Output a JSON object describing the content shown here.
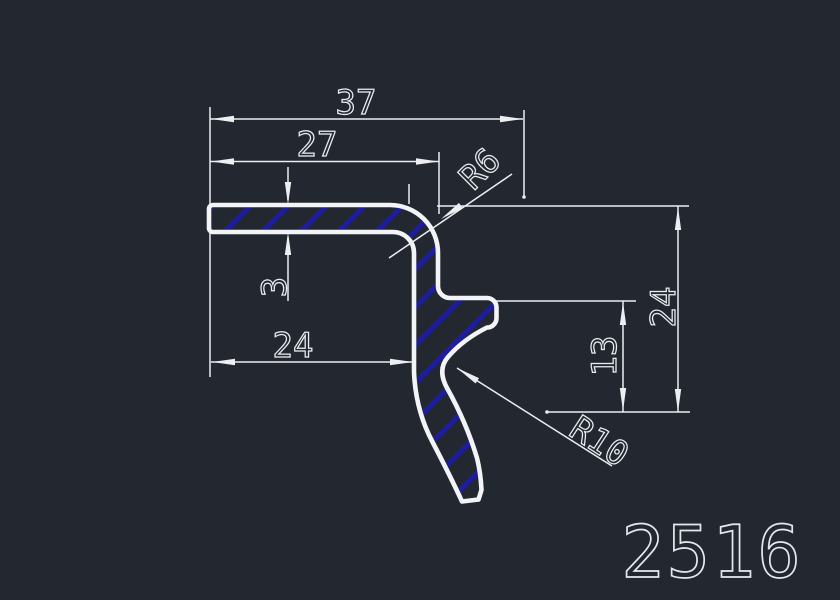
{
  "drawing": {
    "type": "cad-profile-cross-section",
    "part_number": "2516",
    "dimensions": {
      "overall_width": "37",
      "top_arm_length": "27",
      "wall_thickness": "3",
      "leg_length": "24",
      "hook_height": "13",
      "overall_height": "24",
      "corner_radius": "R6",
      "hook_radius": "R10"
    },
    "colors": {
      "background": "#232730",
      "outline": "#f2f4f7",
      "dimension_lines": "#eceef2",
      "hatch": "#1e1e96"
    }
  }
}
